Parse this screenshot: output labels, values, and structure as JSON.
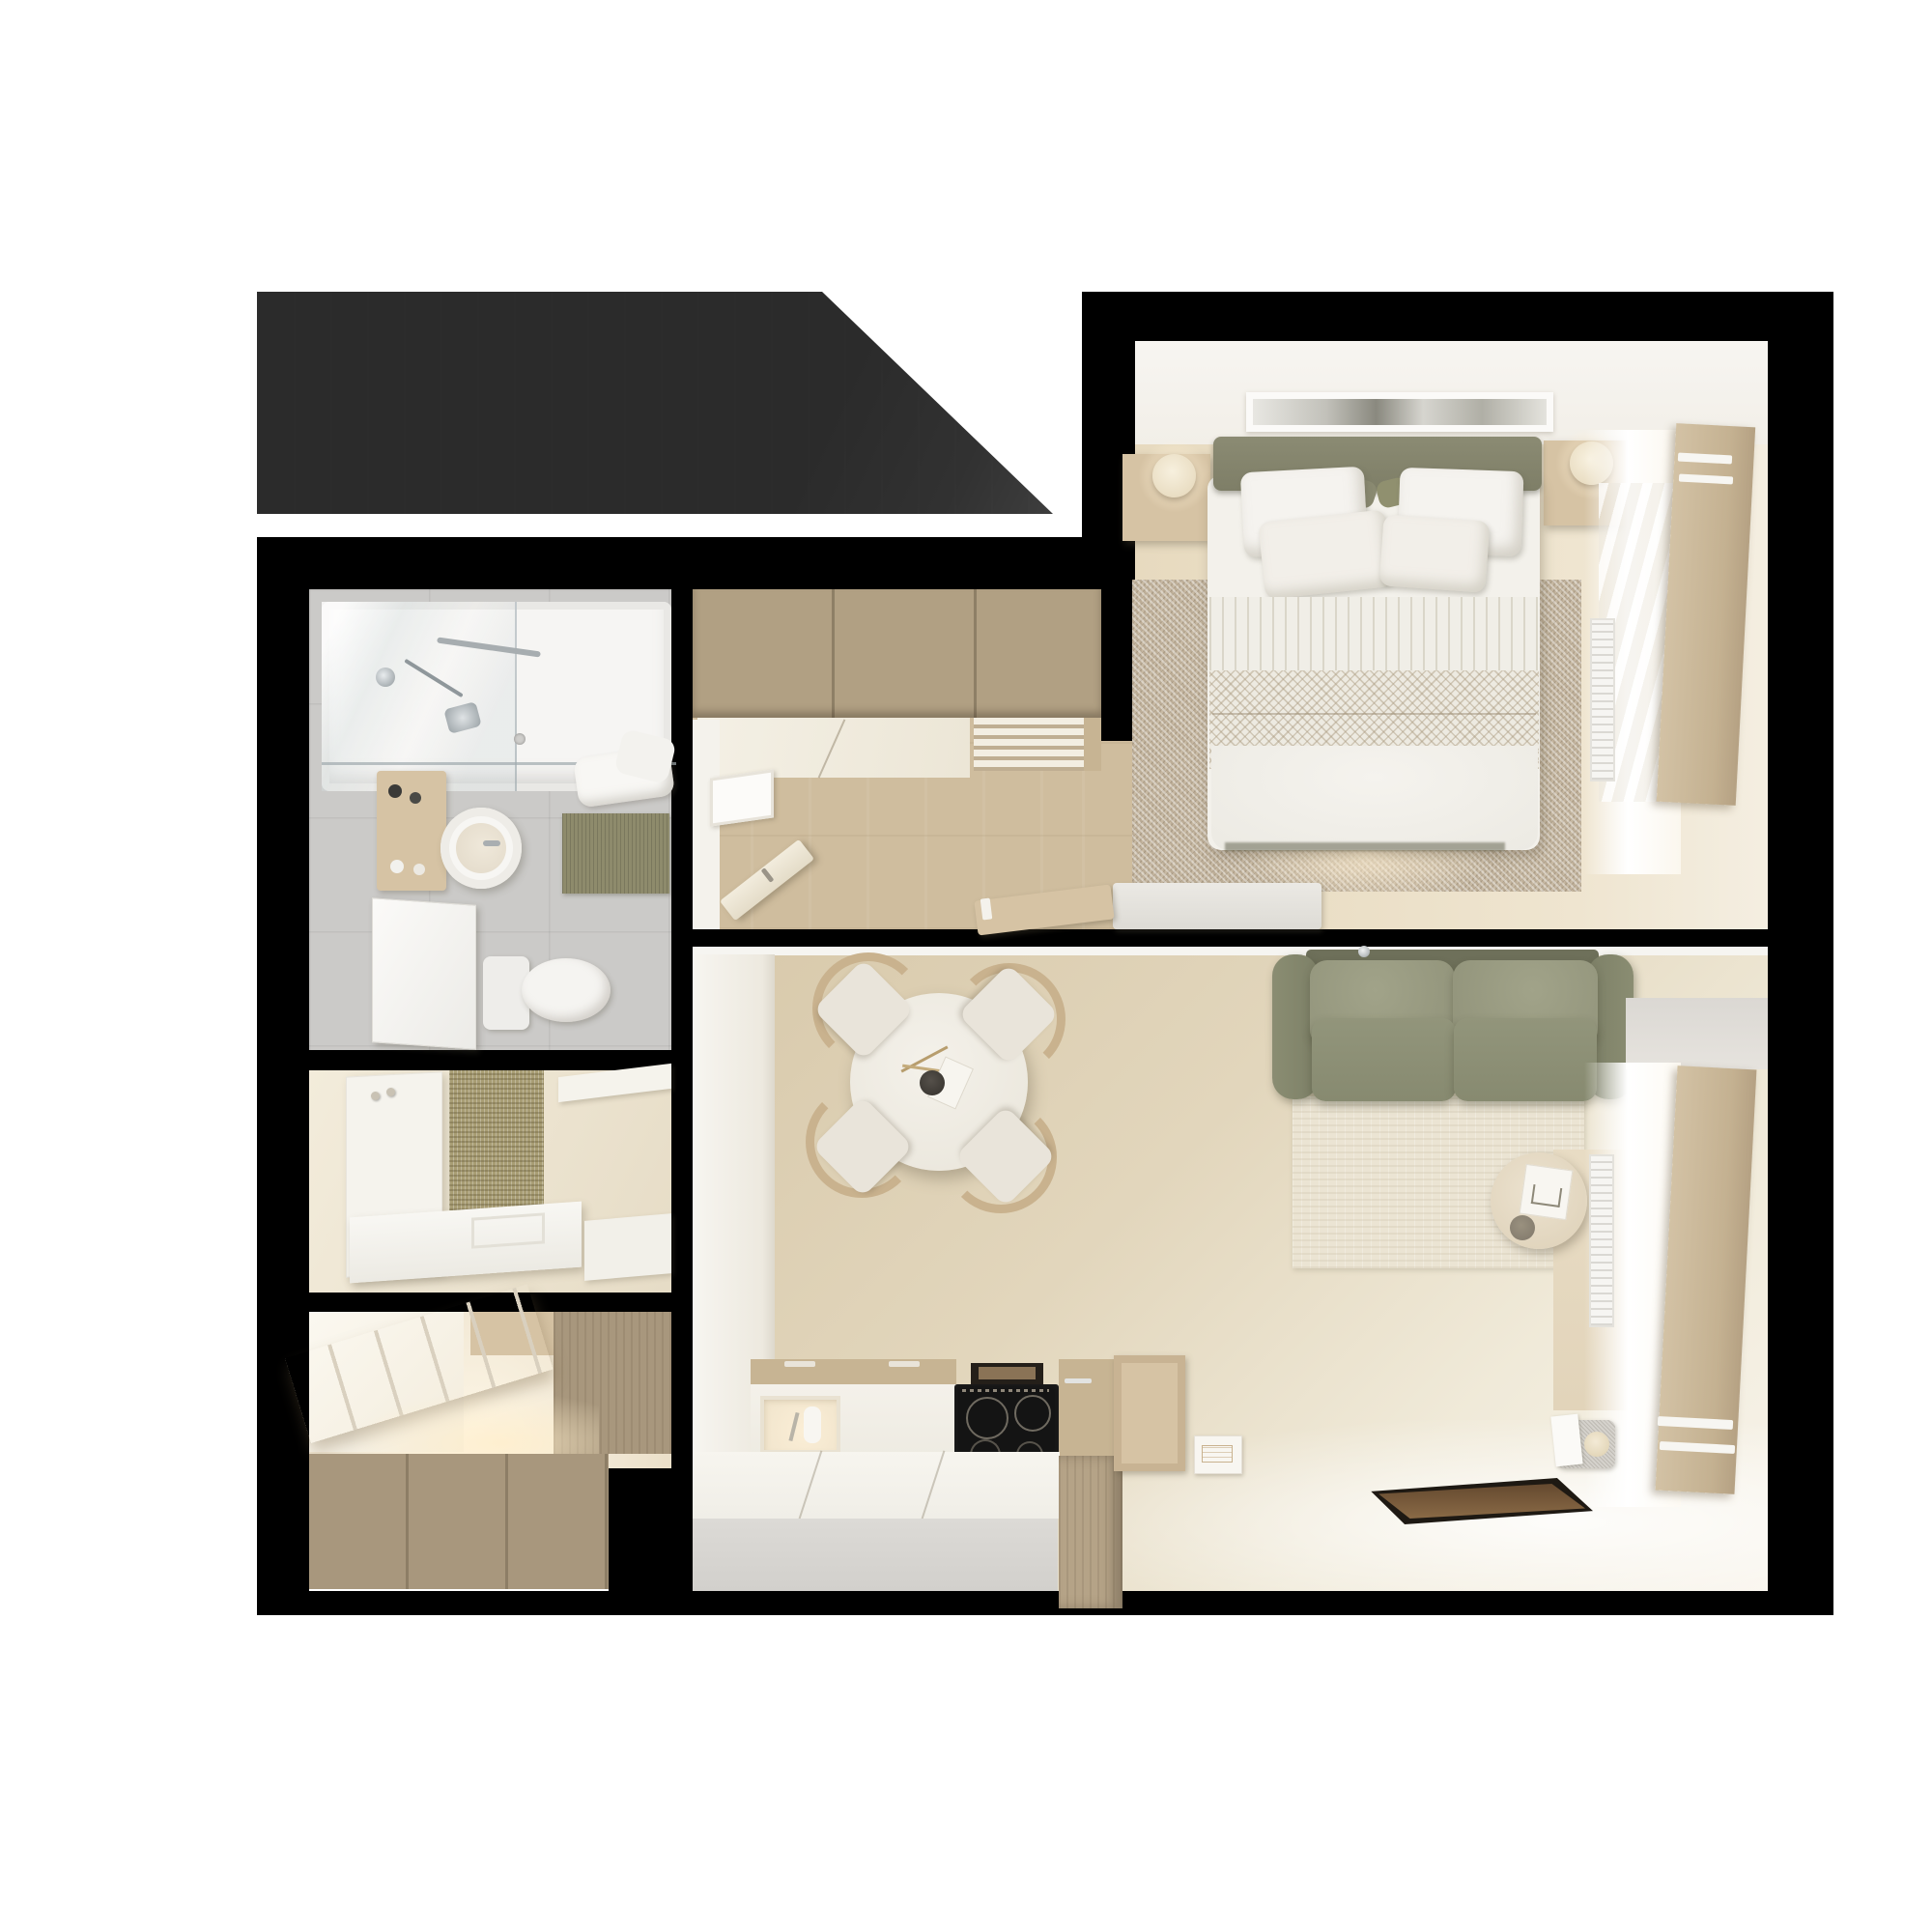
{
  "meta": {
    "image_type": "3d-floor-plan-render",
    "view": "top-down",
    "scene_label": "Studio apartment floor plan",
    "visible_text": "none"
  },
  "colors": {
    "wall": "#000000",
    "terrace": "#4a4a4a",
    "bg": "#ffffff",
    "wood_cab": "#b1a083",
    "wood_light": "#d6c3a4",
    "wood_mid": "#c7b493",
    "wood_dark": "#a8977d",
    "floor_corridor": "#cfbd9e",
    "floor_bedroom": "#e7dabf",
    "floor_living": "#ddcfb2",
    "tile": "#cbcac8",
    "white_soft": "#f4f2ec",
    "sage": "#85856d",
    "sage_light": "#9b9d83",
    "sage_seat": "#8d9076",
    "rug_speckle": "#c7b9a3",
    "rug_cream": "#ebe4d3",
    "jute": "#a89d74",
    "olive_mat": "#8e8b6c",
    "linen": "#f3f1eb",
    "chair_wood": "#c9b28e",
    "cooktop": "#141414",
    "tray": "#5c452f",
    "glow": "#fdf3de"
  },
  "rooms": {
    "terrace": {
      "label": "Terrace / roof area"
    },
    "bedroom": {
      "label": "Bedroom",
      "furniture": [
        "double-bed",
        "headboard",
        "pillows",
        "nightstand-left",
        "nightstand-right",
        "lamps",
        "area-rug",
        "artwork-panel",
        "foot-bench",
        "desk-chair",
        "window-shutter-panel",
        "radiator"
      ]
    },
    "bathroom": {
      "label": "Bathroom",
      "furniture": [
        "bathtub",
        "shower-glass",
        "shower-fixtures",
        "towels",
        "vanity-shelf",
        "round-basin",
        "mirror-door",
        "toilet",
        "bath-mat"
      ]
    },
    "hallway": {
      "label": "Entry hall",
      "furniture": [
        "coat-panel-with-hooks",
        "jute-runner",
        "bench"
      ]
    },
    "closet": {
      "label": "Walk-in closet",
      "furniture": [
        "wardrobe",
        "open-shelf-unit",
        "base-cabinets"
      ]
    },
    "kitchen": {
      "label": "Kitchen corridor",
      "furniture": [
        "upper-cabinets",
        "counter",
        "plate-rack",
        "open-door",
        "framed-panel"
      ]
    },
    "living": {
      "label": "Living / dining room",
      "furniture": [
        "sofa",
        "back-cushions",
        "seat-cushions",
        "coffee-side-table",
        "book",
        "cup",
        "cream-rug",
        "dining-table",
        "four-chairs",
        "vase-sprig",
        "kitchen-counter",
        "sink",
        "induction-cooktop",
        "vent",
        "peninsula",
        "brown-tray",
        "paper-box",
        "stone-object",
        "window-shutter-panel",
        "radiator"
      ]
    }
  }
}
